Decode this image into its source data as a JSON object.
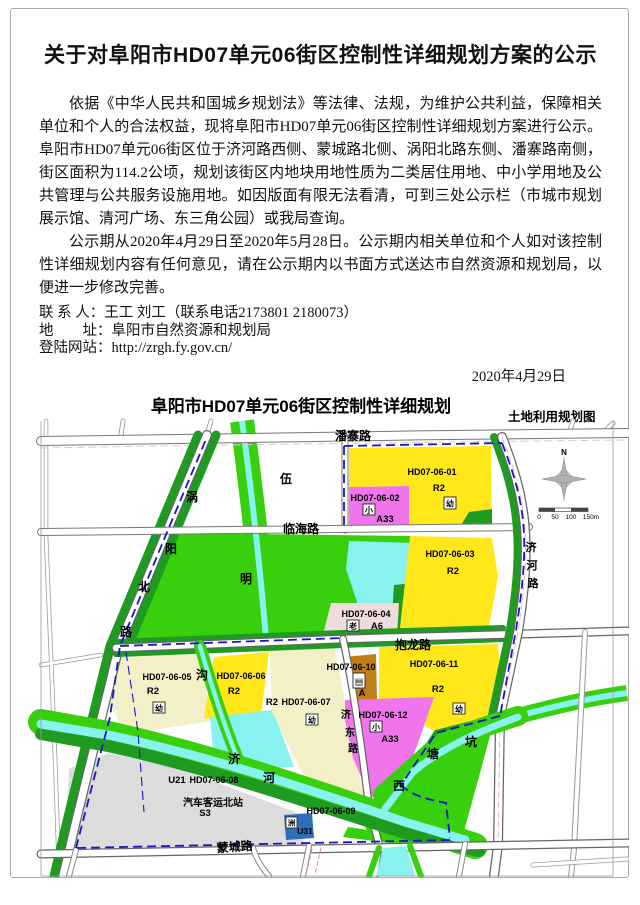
{
  "notice": {
    "title": "关于对阜阳市HD07单元06街区控制性详细规划方案的公示",
    "paragraph1": "依据《中华人民共和国城乡规划法》等法律、法规，为维护公共利益，保障相关单位和个人的合法权益，现将阜阳市HD07单元06街区控制性详细规划方案进行公示。阜阳市HD07单元06街区位于济河路西侧、蒙城路北侧、涡阳北路东侧、潘寨路南侧，街区面积为114.2公顷，规划该街区内地块用地性质为二类居住用地、中小学用地及公共管理与公共服务设施用地。如因版面有限无法看清，可到三处公示栏（市城市规划展示馆、清河广场、东三角公园）或我局查询。",
    "paragraph2": "公示期从2020年4月29日至2020年5月28日。公示期内相关单位和个人如对该控制性详细规划内容有任何意见，请在公示期内以书面方式送达市自然资源和规划局，以便进一步修改完善。",
    "contact_line": "联 系 人：王工 刘工（联系电话2173801 2180073）",
    "address_line": "地　　址：阜阳市自然资源和规划局",
    "website_line": "登陆网站：http://zrgh.fy.gov.cn/",
    "date": "2020年4月29日"
  },
  "map": {
    "title": "阜阳市HD07单元06街区控制性详细规划",
    "subtitle": "土地利用规划图",
    "compass_n": "N",
    "scale_labels": [
      "0",
      "50",
      "100",
      "150m"
    ],
    "roads": {
      "panzhai": "潘寨路",
      "linhai": "临海路",
      "baolong": "抱龙路",
      "mengcheng": "蒙城路",
      "woyang_chars": [
        "涡",
        "阳",
        "北",
        "路"
      ],
      "jihe_chars": [
        "济",
        "河",
        "路"
      ],
      "jidong_chars": [
        "济",
        "东",
        "路"
      ]
    },
    "waters": {
      "wuming_chars": [
        "伍",
        "明"
      ],
      "gou": "沟",
      "jihe_river_chars": [
        "济",
        "河"
      ],
      "xitangkeng_chars": [
        "坑",
        "塘",
        "西"
      ]
    },
    "blocks": [
      {
        "code": "HD07-06-01",
        "use": "R2",
        "badge": "幼"
      },
      {
        "code": "HD07-06-02",
        "use": "A33",
        "badge": "小"
      },
      {
        "code": "HD07-06-03",
        "use": "R2"
      },
      {
        "code": "HD07-06-04",
        "use": "A6",
        "badge": "老"
      },
      {
        "code": "HD07-06-05",
        "use": "R2",
        "badge": "幼"
      },
      {
        "code": "HD07-06-06",
        "use": "R2"
      },
      {
        "code": "HD07-06-07",
        "use": "R2",
        "badge": "幼"
      },
      {
        "code": "HD07-06-08",
        "use": "U21",
        "facility": "汽车客运北站",
        "facility_code": "S3"
      },
      {
        "code": "HD07-06-09"
      },
      {
        "code": "HD07-06-10",
        "use": "A",
        "badge": "▤"
      },
      {
        "code": "HD07-06-11",
        "use": "R2",
        "badge": "幼"
      },
      {
        "code": "HD07-06-12",
        "use": "A33",
        "badge": "小"
      },
      {
        "code": "U31",
        "badge": "洲"
      }
    ],
    "colors": {
      "residential_r2": "#FFE719",
      "residential_cream": "#F3F0C8",
      "education_a33": "#F075EC",
      "elderly_a6": "#F0DCDC",
      "admin_a": "#C08018",
      "transport_gray": "#DCDCDC",
      "utility_u31": "#2C6FB8",
      "green_bright": "#38CF0D",
      "green_dark": "#1F9B22",
      "water_cyan": "#87F2EE",
      "boundary_blue": "#1717C3"
    }
  }
}
